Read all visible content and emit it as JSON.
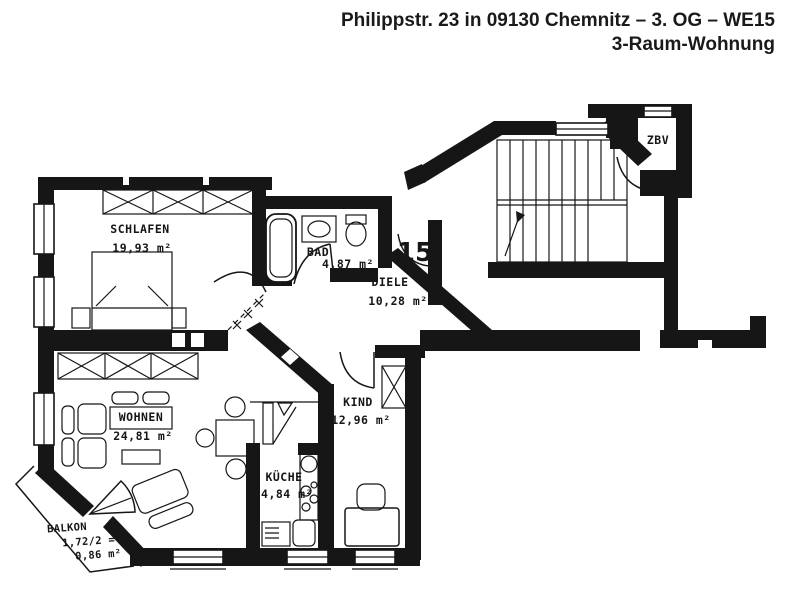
{
  "header": {
    "title_line1": "Philippstr. 23 in 09130 Chemnitz – 3. OG – WE15",
    "title_line2": "3-Raum-Wohnung"
  },
  "rooms": {
    "schlafen": {
      "name": "SCHLAFEN",
      "area": "19,93 m²"
    },
    "bad": {
      "name": "BAD",
      "area": "4,87 m²"
    },
    "diele": {
      "name": "DIELE",
      "area": "10,28 m²"
    },
    "kind": {
      "name": "KIND",
      "area": "12,96 m²"
    },
    "wohnen": {
      "name": "WOHNEN",
      "area": "24,81 m²"
    },
    "kueche": {
      "name": "KÜCHE",
      "area": "4,84 m²"
    },
    "balkon": {
      "name": "BALKON",
      "calc": "1,72/2 =",
      "area": "0,86 m²"
    },
    "zbv": {
      "name": "ZBV"
    }
  },
  "labels": {
    "apartment_number": "15"
  },
  "colors": {
    "ink": "#161616",
    "paper": "#ffffff"
  }
}
